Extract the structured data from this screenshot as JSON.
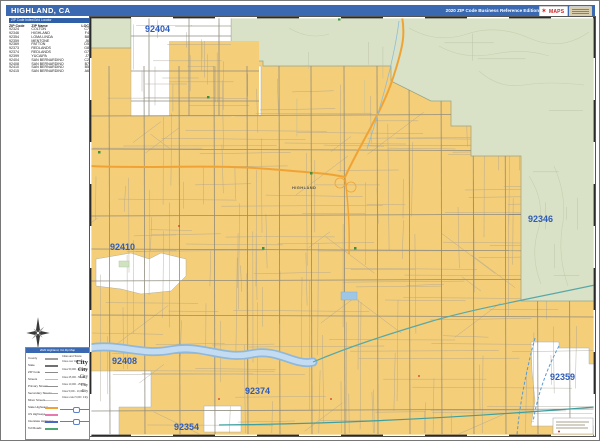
{
  "header": {
    "title": "HIGHLAND, CA",
    "edition": "2020 ZIP Code Business Reference Edition",
    "logo": {
      "brand": "MAPS",
      "star": "✶"
    }
  },
  "zip_index": {
    "title": "ZIP Code Index/Grid Locator",
    "columns": [
      "ZIP Code",
      "ZIP Name",
      "LOC"
    ],
    "rows": [
      [
        "92324",
        "COLTON",
        "C7"
      ],
      [
        "92346",
        "HIGHLAND",
        "F4"
      ],
      [
        "92354",
        "LOMA LINDA",
        "B8"
      ],
      [
        "92359",
        "MENTONE",
        "J6"
      ],
      [
        "92369",
        "PATTON",
        "D5"
      ],
      [
        "92373",
        "REDLANDS",
        "G8"
      ],
      [
        "92374",
        "REDLANDS",
        "G7"
      ],
      [
        "92399",
        "YUCAIPA",
        "J7"
      ],
      [
        "92404",
        "SAN BERNARDINO",
        "C2"
      ],
      [
        "92408",
        "SAN BERNARDINO",
        "B7"
      ],
      [
        "92410",
        "SAN BERNARDINO",
        "B5"
      ],
      [
        "92415",
        "SAN BERNARDINO",
        "A6"
      ]
    ]
  },
  "map": {
    "zip_labels": [
      "92404",
      "92346",
      "92410",
      "92408",
      "92374",
      "92354",
      "92359"
    ],
    "city_labels": [
      "HIGHLAND"
    ]
  },
  "legend": {
    "title": "2020 Highland, CA Zip Map",
    "line_items": [
      {
        "label": "County",
        "color": "#9e9e9e"
      },
      {
        "label": "State",
        "color": "#707070"
      },
      {
        "label": "ZIP Code",
        "color": "#8a8a8a"
      },
      {
        "label": "Streets",
        "color": "#bdbdbd"
      },
      {
        "label": "Primary Streets",
        "color": "#8f8f8f"
      },
      {
        "label": "Secondary Streets",
        "color": "#a5a5a5"
      },
      {
        "label": "Minor Streets",
        "color": "#c6c6c6"
      },
      {
        "label": "State Highways",
        "color": "#f0a335"
      },
      {
        "label": "US Highways",
        "color": "#e878b0"
      },
      {
        "label": "Interstate Highways",
        "color": "#4a67c8"
      },
      {
        "label": "Toll Roads",
        "color": "#4aa870"
      }
    ],
    "cities_header": "Cities and Towns",
    "city_items": [
      {
        "range": "Cities over 100,000",
        "sample": "City"
      },
      {
        "range": "Cities 50,000 - 100,000",
        "sample": "City"
      },
      {
        "range": "Cities 25,000 - 50,000",
        "sample": "City"
      },
      {
        "range": "Cities 10,000 - 25,000",
        "sample": "City"
      },
      {
        "range": "Cities 5,000 - 10,000",
        "sample": "City"
      },
      {
        "range": "Cities under 5,000",
        "sample": "City"
      }
    ]
  },
  "colors": {
    "header_bg": "#3a69b2",
    "zip_fill_yellow": "#f4ce79",
    "terrain_green": "#d9e2c6",
    "water_blue": "#a9cbe8",
    "canal_teal": "#3f9e9e",
    "highway_orange": "#f0a335",
    "zip_label_blue": "#2e5cb8"
  }
}
